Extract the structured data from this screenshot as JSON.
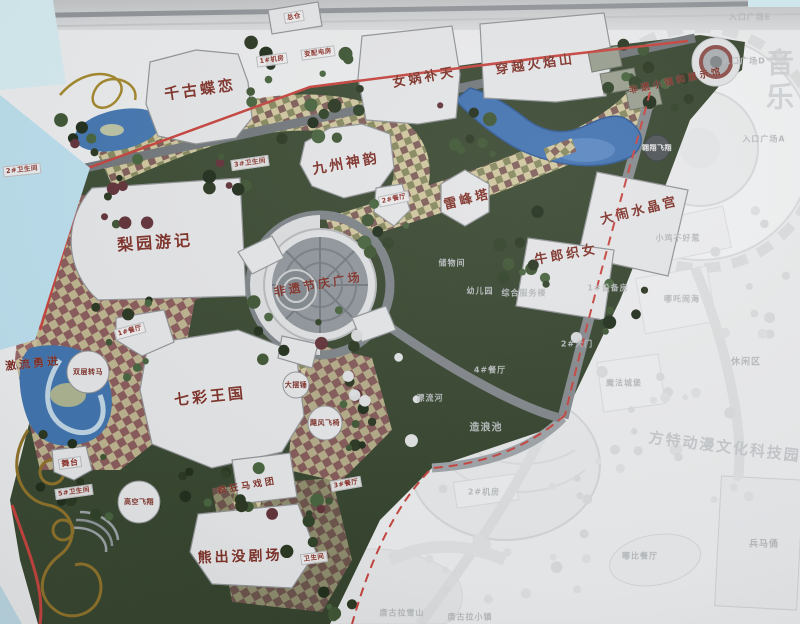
{
  "scene": {
    "description": "Photographed master-plan map of a theme park; colored zone with Chinese attraction labels, adjacent ghosted white zone"
  },
  "palette": {
    "park_green": "#36452f",
    "water_blue": "#3e6fae",
    "red_boundary": "#c4403a",
    "label_red": "#7b2d24",
    "ghost_text": "#b4b8ba",
    "checker_tan": "#cdc49b",
    "paved_maroon": "#8e5a5c",
    "board_cyan": "#b9dcea"
  },
  "map": {
    "attractions": [
      {
        "label": "千古蝶恋",
        "x": 200,
        "y": 89,
        "size": 15,
        "rot": -8
      },
      {
        "label": "女娲补天",
        "x": 424,
        "y": 76,
        "size": 13,
        "rot": -10
      },
      {
        "label": "穿越火焰山",
        "x": 535,
        "y": 63,
        "size": 13,
        "rot": -8
      },
      {
        "label": "九州神韵",
        "x": 346,
        "y": 163,
        "size": 14,
        "rot": -10
      },
      {
        "label": "梨园游记",
        "x": 155,
        "y": 241,
        "size": 16,
        "rot": -4
      },
      {
        "label": "雷峰塔",
        "x": 467,
        "y": 198,
        "size": 13,
        "rot": -14
      },
      {
        "label": "大闹水晶宫",
        "x": 639,
        "y": 209,
        "size": 13,
        "rot": -14
      },
      {
        "label": "牛郎织女",
        "x": 566,
        "y": 253,
        "size": 13,
        "rot": -10
      },
      {
        "label": "非遗节庆广场",
        "x": 318,
        "y": 284,
        "size": 12,
        "rot": -10
      },
      {
        "label": "七彩王国",
        "x": 210,
        "y": 396,
        "size": 15,
        "rot": -6
      },
      {
        "label": "熊出没剧场",
        "x": 240,
        "y": 556,
        "size": 14,
        "rot": -2
      },
      {
        "label": "非遗小镇和展示馆",
        "x": 676,
        "y": 80,
        "size": 9,
        "rot": -12
      },
      {
        "label": "激流勇进",
        "x": 33,
        "y": 363,
        "size": 11,
        "rot": -6
      },
      {
        "label": "疯狂马戏团",
        "x": 247,
        "y": 485,
        "size": 9,
        "rot": -10
      }
    ],
    "rides": [
      {
        "label": "双层转马",
        "x": 88,
        "y": 372,
        "r": 21
      },
      {
        "label": "高空飞翔",
        "x": 139,
        "y": 502,
        "r": 21
      },
      {
        "label": "飓风飞椅",
        "x": 325,
        "y": 423,
        "r": 17
      },
      {
        "label": "大摆锤",
        "x": 296,
        "y": 385,
        "r": 13
      },
      {
        "label": "翱翔飞翔",
        "x": 657,
        "y": 148,
        "r": 13,
        "dark": true
      }
    ],
    "facilities": [
      {
        "label": "总仓",
        "x": 294,
        "y": 17,
        "rot": -10
      },
      {
        "label": "1#机房",
        "x": 272,
        "y": 60,
        "rot": -8
      },
      {
        "label": "变配电房",
        "x": 318,
        "y": 53,
        "rot": -8
      },
      {
        "label": "2#卫生间",
        "x": 22,
        "y": 170,
        "rot": -6
      },
      {
        "label": "3#卫生间",
        "x": 250,
        "y": 163,
        "rot": -8
      },
      {
        "label": "2#餐厅",
        "x": 394,
        "y": 199,
        "rot": -12
      },
      {
        "label": "1#餐厅",
        "x": 130,
        "y": 331,
        "rot": -15
      },
      {
        "label": "3#餐厅",
        "x": 346,
        "y": 484,
        "rot": -10
      },
      {
        "label": "舞台",
        "x": 70,
        "y": 463,
        "rot": -8,
        "size": 8
      },
      {
        "label": "5#卫生间",
        "x": 74,
        "y": 492,
        "rot": -8
      },
      {
        "label": "卫生间",
        "x": 314,
        "y": 558,
        "rot": -8
      }
    ],
    "ghost_labels": [
      {
        "label": "入口广场E",
        "x": 750,
        "y": 17
      },
      {
        "label": "入口广场D",
        "x": 744,
        "y": 61
      },
      {
        "label": "入口广场A",
        "x": 764,
        "y": 139
      },
      {
        "label": "储物间",
        "x": 452,
        "y": 263
      },
      {
        "label": "幼儿园",
        "x": 480,
        "y": 291
      },
      {
        "label": "综合服务楼",
        "x": 524,
        "y": 293
      },
      {
        "label": "1#设备房",
        "x": 608,
        "y": 288
      },
      {
        "label": "小鸡不好惹",
        "x": 678,
        "y": 238
      },
      {
        "label": "哪吒闹海",
        "x": 682,
        "y": 299
      },
      {
        "label": "休闲区",
        "x": 746,
        "y": 361,
        "size": 9
      },
      {
        "label": "魔法城堡",
        "x": 624,
        "y": 383
      },
      {
        "label": "2#大门",
        "x": 577,
        "y": 344
      },
      {
        "label": "4#餐厅",
        "x": 490,
        "y": 370
      },
      {
        "label": "漂流河",
        "x": 430,
        "y": 398
      },
      {
        "label": "造浪池",
        "x": 486,
        "y": 426,
        "size": 10
      },
      {
        "label": "2#机房",
        "x": 484,
        "y": 492
      },
      {
        "label": "嘟比餐厅",
        "x": 640,
        "y": 556
      },
      {
        "label": "唐古拉雪山",
        "x": 402,
        "y": 613
      },
      {
        "label": "唐古拉小镇",
        "x": 470,
        "y": 617
      },
      {
        "label": "兵马俑",
        "x": 764,
        "y": 543,
        "size": 9
      }
    ],
    "ghost_big_text": {
      "text": "方特动漫文化科技园"
    },
    "ghost_vertical_text": {
      "text": "音乐"
    }
  }
}
